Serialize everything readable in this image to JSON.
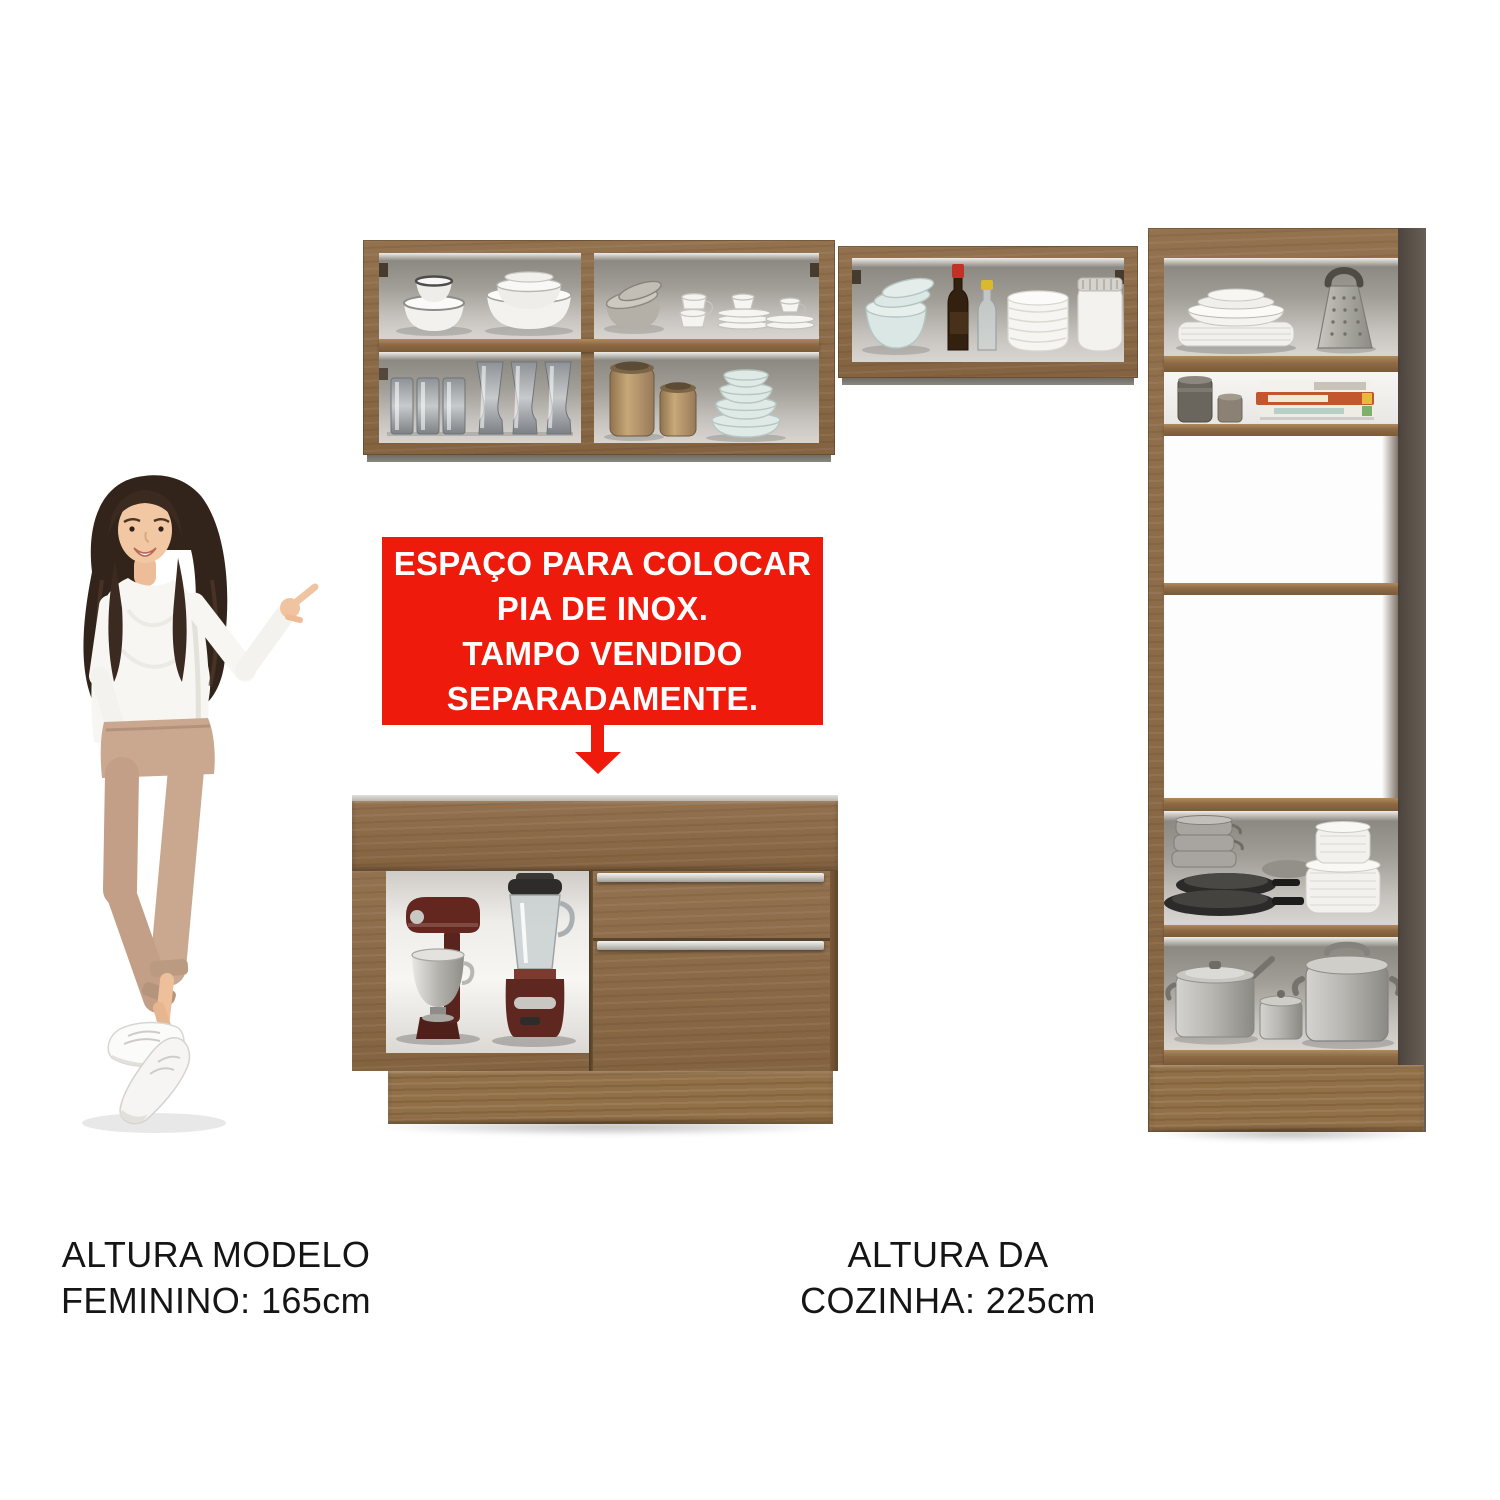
{
  "image": {
    "description": "Product photo: modular kitchen cabinet set (wall cabinets, tall pantry cabinet, sink base cabinet) with a female model pointing at the sink cabinet area",
    "background_color": "#ffffff"
  },
  "callout": {
    "lines": [
      "ESPAÇO PARA COLOCAR",
      "PIA DE INOX.",
      "TAMPO VENDIDO",
      "SEPARADAMENTE."
    ],
    "background_color": "#ee1b0c",
    "text_color": "#ffffff",
    "arrow_icon": "down-arrow"
  },
  "captions": {
    "model_height": {
      "line1": "ALTURA MODELO",
      "line2": "FEMININO: 165cm"
    },
    "kitchen_height": {
      "line1": "ALTURA DA",
      "line2": "COZINHA: 225cm"
    }
  },
  "colors": {
    "page_bg": "#ffffff",
    "wood": "#8d6a45",
    "wood_deep": "#7a5a38",
    "wood_plinth": "#916f47",
    "side_panel_dark": "#5e544b",
    "interior_shade": "#8f8b85",
    "interior_light": "#d6d3ce",
    "accent_red": "#ee1b0c",
    "callout_text": "#ffffff"
  }
}
